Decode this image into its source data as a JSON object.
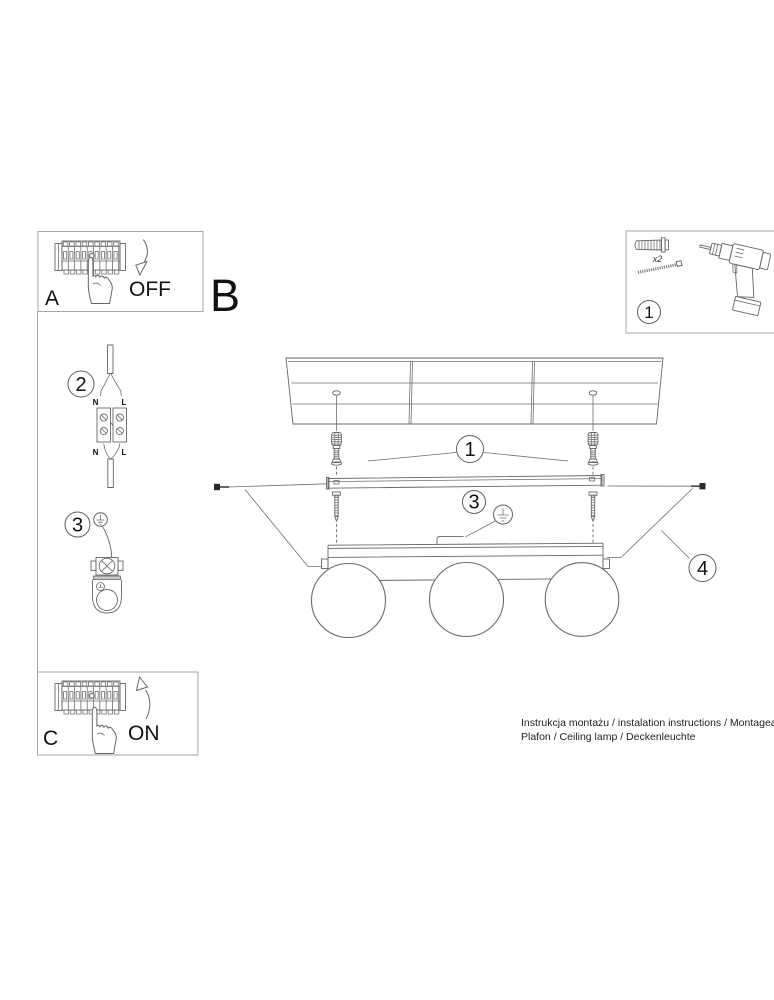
{
  "colors": {
    "background": "#ffffff",
    "line": "#666666",
    "box_border": "#a6a6a6",
    "text": "#111111",
    "screw_head": "#2b2b2b"
  },
  "power_off_step": {
    "letter": "A",
    "switch_state": "OFF"
  },
  "section_label": "B",
  "mounting_kit": {
    "step_number": "1",
    "anchor_quantity": "x2"
  },
  "wiring_step": {
    "step_number": "2",
    "input_neutral": "N",
    "input_live": "L",
    "output_neutral": "N",
    "output_live": "L"
  },
  "grounding_step": {
    "step_number": "3"
  },
  "assembly_diagram": {
    "anchors_callout": "1",
    "ground_callout": "3",
    "side_screws_callout": "4"
  },
  "power_on_step": {
    "letter": "C",
    "switch_state": "ON"
  },
  "footer": {
    "title_line": "Instrukcja montażu / instalation instructions / Montageanleitu",
    "product_line": "Plafon / Ceiling lamp / Deckenleuchte"
  },
  "icons": {
    "breaker": "circuit-breaker-strip",
    "hand": "pressing-hand",
    "arrow_down": "curved-arrow-down",
    "arrow_up": "curved-arrow-up",
    "wall_plug": "wall-plug-anchor",
    "screw": "mounting-screw",
    "drill": "power-drill",
    "ground": "earth-ground-symbol",
    "terminal": "terminal-block",
    "lamp": "three-globe-ceiling-lamp"
  }
}
